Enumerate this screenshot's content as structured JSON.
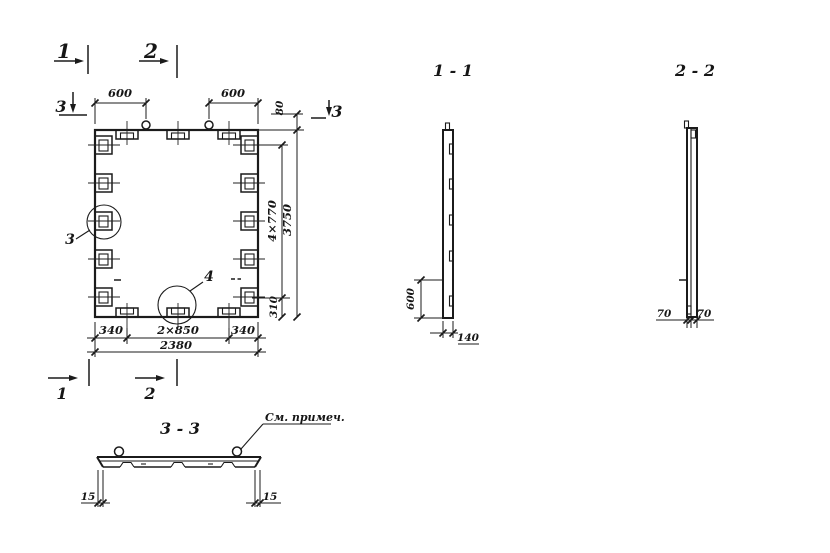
{
  "plan": {
    "markers": {
      "top_1": "1",
      "top_2": "2",
      "left_3": "3",
      "right_3": "3",
      "bottom_1": "1",
      "bottom_2": "2"
    },
    "callouts": {
      "detail_3": "3",
      "detail_4": "4"
    },
    "dims": {
      "top_600_left": "600",
      "top_600_right": "600",
      "right_80": "80",
      "right_4x770": "4×770",
      "right_3750": "3750",
      "right_310": "310",
      "bottom_340_left": "340",
      "bottom_2x850": "2×850",
      "bottom_340_right": "340",
      "bottom_total_2380": "2380"
    }
  },
  "section_1_1": {
    "title": "1 - 1",
    "dim_600": "600",
    "dim_140": "140"
  },
  "section_2_2": {
    "title": "2 - 2",
    "dim_70_left": "70",
    "dim_70_right": "70"
  },
  "section_3_3": {
    "title": "3 - 3",
    "note": "См. примеч.",
    "dim_15_left": "15",
    "dim_15_right": "15"
  }
}
